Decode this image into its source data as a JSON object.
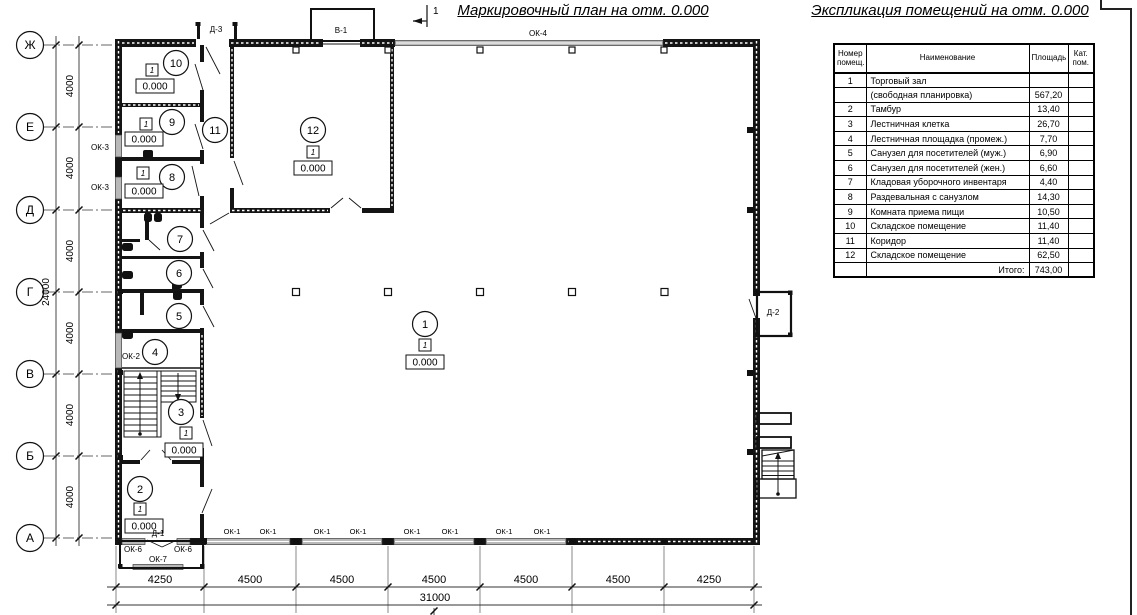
{
  "sheet": {
    "plan_title": "Маркировочный план на отм. 0.000",
    "explication_title": "Экспликация помещений на отм. 0.000",
    "section_mark": "1"
  },
  "axes": {
    "rows": [
      "Ж",
      "Е",
      "Д",
      "Г",
      "В",
      "Б",
      "А"
    ],
    "row_dims": [
      "4000",
      "4000",
      "4000",
      "4000",
      "4000",
      "4000"
    ],
    "rows_total": "24000",
    "col_dims": [
      "4250",
      "4500",
      "4500",
      "4500",
      "4500",
      "4500",
      "4250"
    ],
    "cols_total": "31000"
  },
  "marks": {
    "ok1": "ОК-1",
    "ok2": "ОК-2",
    "ok3": "ОК-3",
    "ok4": "ОК-4",
    "ok6": "ОК-6",
    "ok7": "ОК-7",
    "d1": "Д-1",
    "d2": "Д-2",
    "d3": "Д-3",
    "v1": "В-1"
  },
  "rooms": {
    "r1": {
      "num": "1",
      "cat": "1",
      "level": "0.000"
    },
    "r2": {
      "num": "2",
      "cat": "1",
      "level": "0.000"
    },
    "r3": {
      "num": "3",
      "cat": "1",
      "level": "0.000"
    },
    "r4": {
      "num": "4"
    },
    "r5": {
      "num": "5"
    },
    "r6": {
      "num": "6"
    },
    "r7": {
      "num": "7"
    },
    "r8": {
      "num": "8",
      "cat": "1",
      "level": "0.000"
    },
    "r9": {
      "num": "9",
      "cat": "1",
      "level": "0.000"
    },
    "r10": {
      "num": "10",
      "cat": "1",
      "level": "0.000"
    },
    "r11": {
      "num": "11"
    },
    "r12": {
      "num": "12",
      "cat": "1",
      "level": "0.000"
    }
  },
  "table": {
    "headers": [
      "Номер помещ.",
      "Наименование",
      "Площадь",
      "Кат. пом."
    ],
    "rows": [
      {
        "num": "1",
        "name": "Торговый зал",
        "area": "",
        "cat": ""
      },
      {
        "num": "",
        "name": "(свободная планировка)",
        "area": "567,20",
        "cat": ""
      },
      {
        "num": "2",
        "name": "Тамбур",
        "area": "13,40",
        "cat": ""
      },
      {
        "num": "3",
        "name": "Лестничная клетка",
        "area": "26,70",
        "cat": ""
      },
      {
        "num": "4",
        "name": "Лестничная площадка (промеж.)",
        "area": "7,70",
        "cat": ""
      },
      {
        "num": "5",
        "name": "Санузел для посетителей (муж.)",
        "area": "6,90",
        "cat": ""
      },
      {
        "num": "6",
        "name": "Санузел для посетителей (жен.)",
        "area": "6,60",
        "cat": ""
      },
      {
        "num": "7",
        "name": "Кладовая уборочного инвентаря",
        "area": "4,40",
        "cat": ""
      },
      {
        "num": "8",
        "name": "Раздевальная с санузлом",
        "area": "14,30",
        "cat": ""
      },
      {
        "num": "9",
        "name": "Комната приема пищи",
        "area": "10,50",
        "cat": ""
      },
      {
        "num": "10",
        "name": "Складское помещение",
        "area": "11,40",
        "cat": ""
      },
      {
        "num": "11",
        "name": "Коридор",
        "area": "11,40",
        "cat": ""
      },
      {
        "num": "12",
        "name": "Складское помещение",
        "area": "62,50",
        "cat": ""
      }
    ],
    "total_label": "Итого:",
    "total_value": "743,00"
  }
}
